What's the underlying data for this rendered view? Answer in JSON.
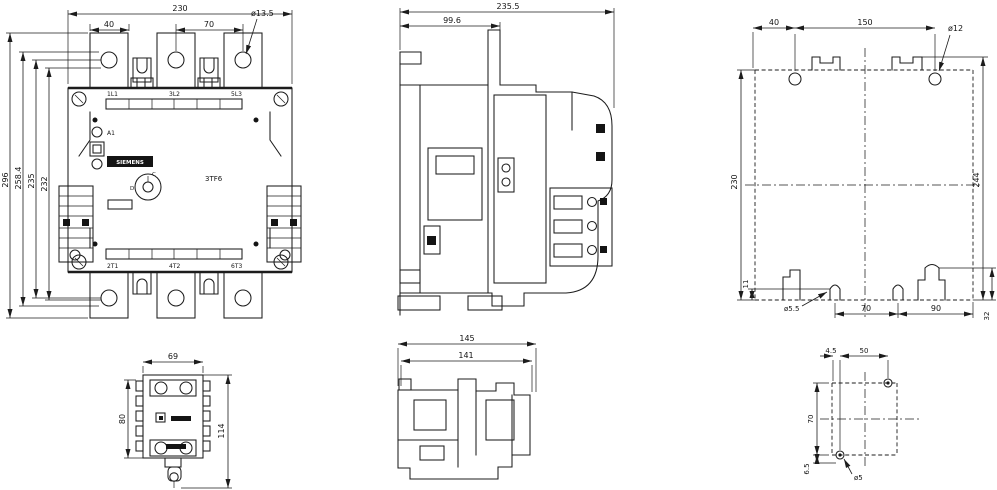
{
  "colors": {
    "line": "#1c1c1c",
    "background": "#ffffff"
  },
  "views": {
    "front": {
      "dims": {
        "width": "230",
        "tab_pitch_a": "40",
        "tab_pitch_b": "70",
        "terminal_hole_dia": "ø13.5",
        "height_1": "296",
        "height_2": "258.4",
        "height_3": "235",
        "height_4": "232"
      },
      "terminals_top": [
        "1L1",
        "3L2",
        "5L3"
      ],
      "terminals_bottom": [
        "2T1",
        "4T2",
        "6T3"
      ],
      "coil_terminals": [
        "A1",
        "A2"
      ],
      "brand": "SIEMENS",
      "model": "3TF6",
      "indicator_letters": [
        "C",
        "D"
      ]
    },
    "side": {
      "dims": {
        "depth": "235.5",
        "depth_to_front": "99.6"
      }
    },
    "mounting_plan": {
      "dims": {
        "hole_offset_x": "40",
        "hole_pitch_x": "150",
        "top_hole_dia": "ø12",
        "height": "230",
        "notch": "11",
        "overall_height": "244",
        "slot_pitch": "70",
        "slot_to_edge": "90",
        "foot_height": "32",
        "slot_dia": "ø5.5"
      }
    },
    "bottom_view": {
      "dims": {
        "width": "69",
        "depth_body": "80",
        "depth_total": "114"
      }
    },
    "bottom_side_view": {
      "dims": {
        "width_1": "145",
        "width_2": "141"
      }
    },
    "aux_mounting_plan": {
      "dims": {
        "hole_offset": "4.5",
        "hole_pitch_x": "50",
        "hole_pitch_y": "70",
        "edge_offset": "6.5",
        "hole_dia": "ø5"
      }
    }
  }
}
